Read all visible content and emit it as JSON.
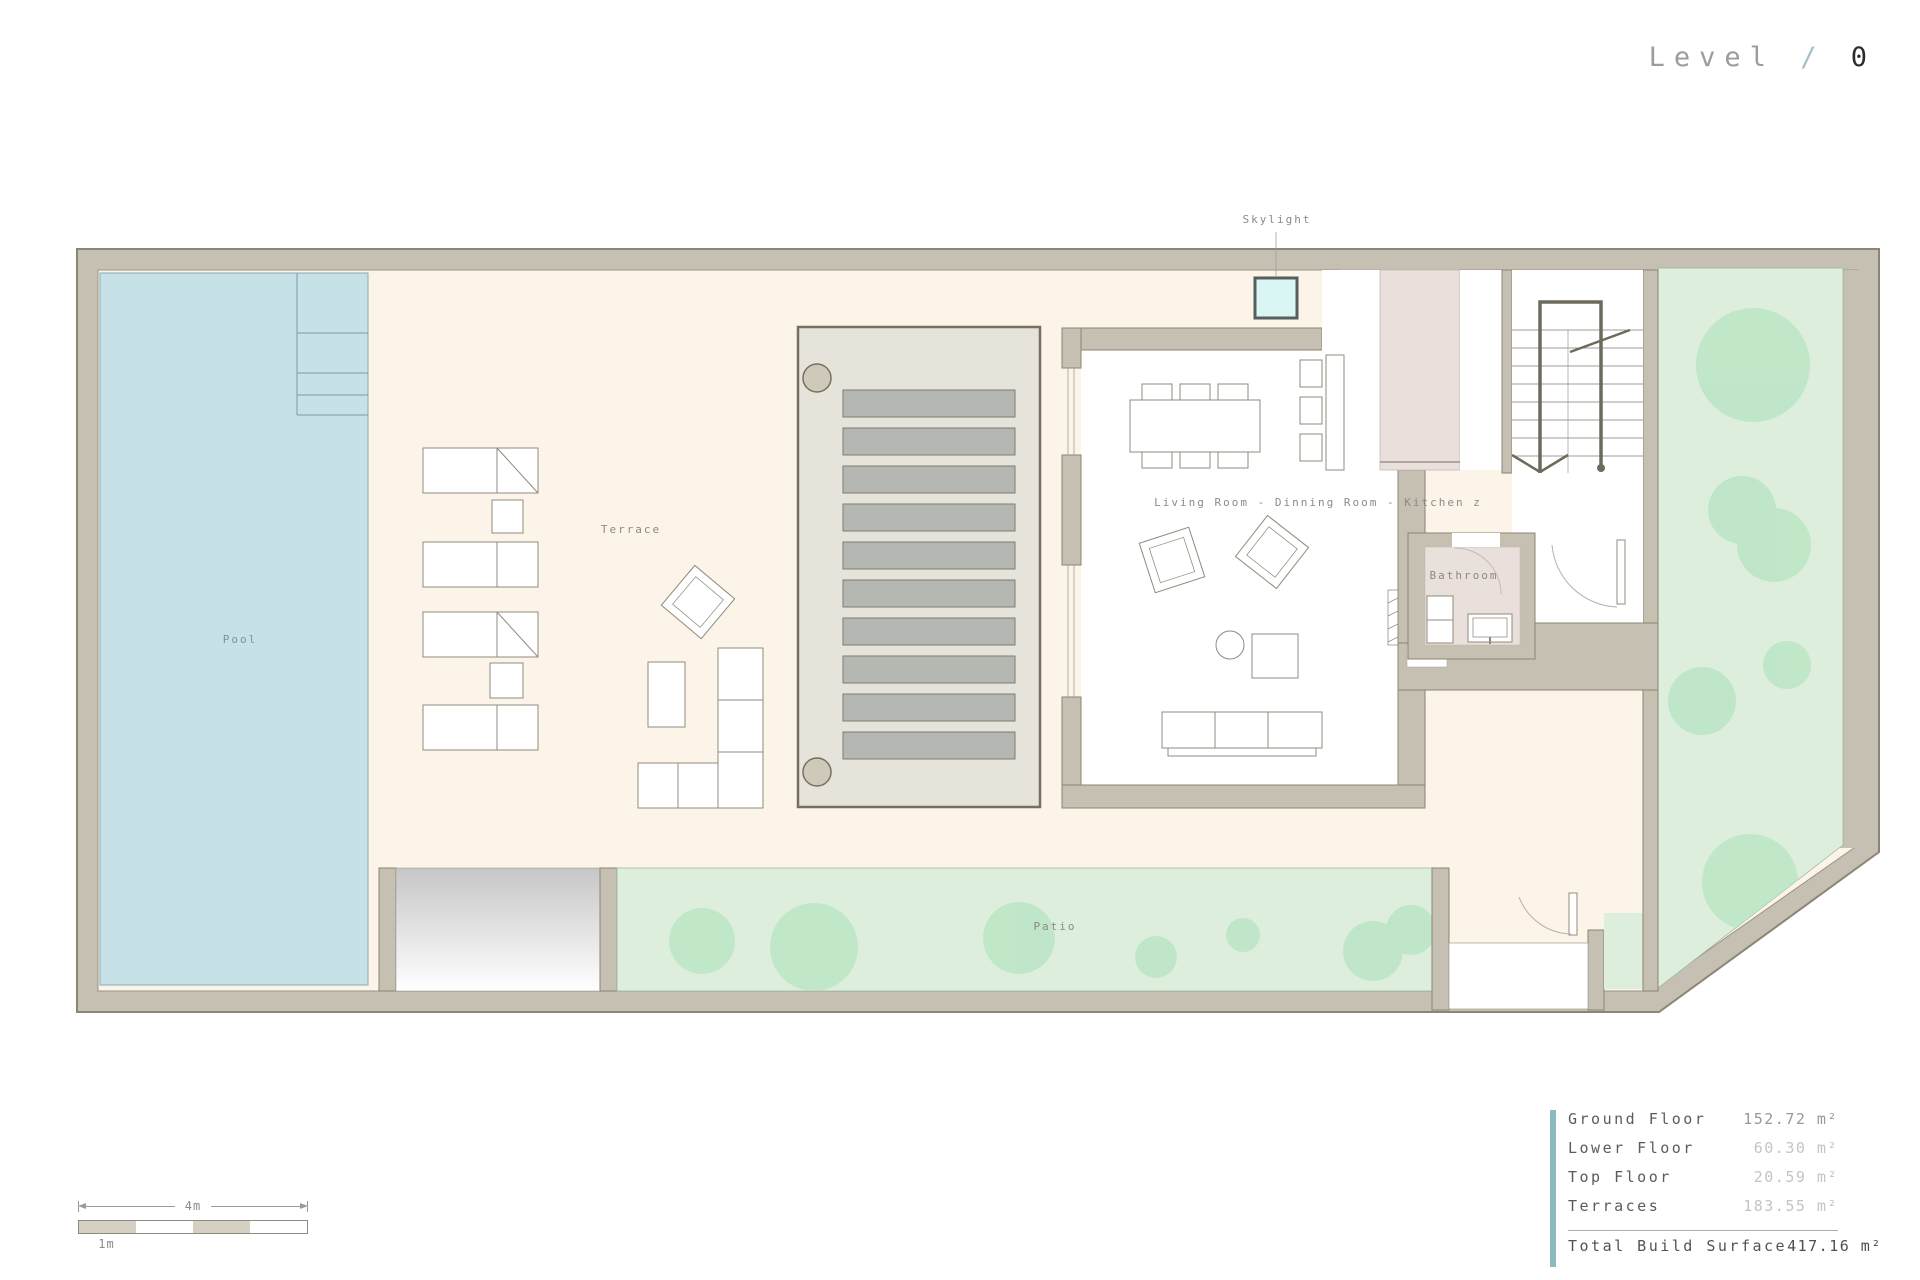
{
  "title": {
    "level_label": "Level",
    "separator": "/",
    "level_number": "0"
  },
  "plan": {
    "labels": {
      "pool": "Pool",
      "terrace": "Terrace",
      "patio": "Patio",
      "skylight": "Skylight",
      "bathroom": "Bathroom",
      "living": "Living Room - Dinning Room - Kitchen z"
    },
    "colors": {
      "wall_taupe": "#c6c0b2",
      "floor_cream": "#fcf3e9",
      "pool_blue": "#c6e1e8",
      "garden_green": "#ddeedd",
      "tree_green": "#bce5c6",
      "pergola_gray": "#e5e3da",
      "slat_gray": "#b5b7b3",
      "kitchen_pink": "#e9dfdb",
      "skylight_cyan": "#d9f6f4",
      "accent_teal": "#8fb9c1",
      "title_slash_blue": "#a6c0cb"
    }
  },
  "scale_bar": {
    "total_label": "4m",
    "unit_label": "1m"
  },
  "area_table": {
    "rows": [
      {
        "label": "Ground Floor",
        "value": "152.72 m²"
      },
      {
        "label": "Lower Floor",
        "value": "60.30 m²"
      },
      {
        "label": "Top Floor",
        "value": "20.59 m²"
      },
      {
        "label": "Terraces",
        "value": "183.55 m²"
      }
    ],
    "total": {
      "label": "Total Build Surface",
      "value": "417.16 m²"
    }
  }
}
